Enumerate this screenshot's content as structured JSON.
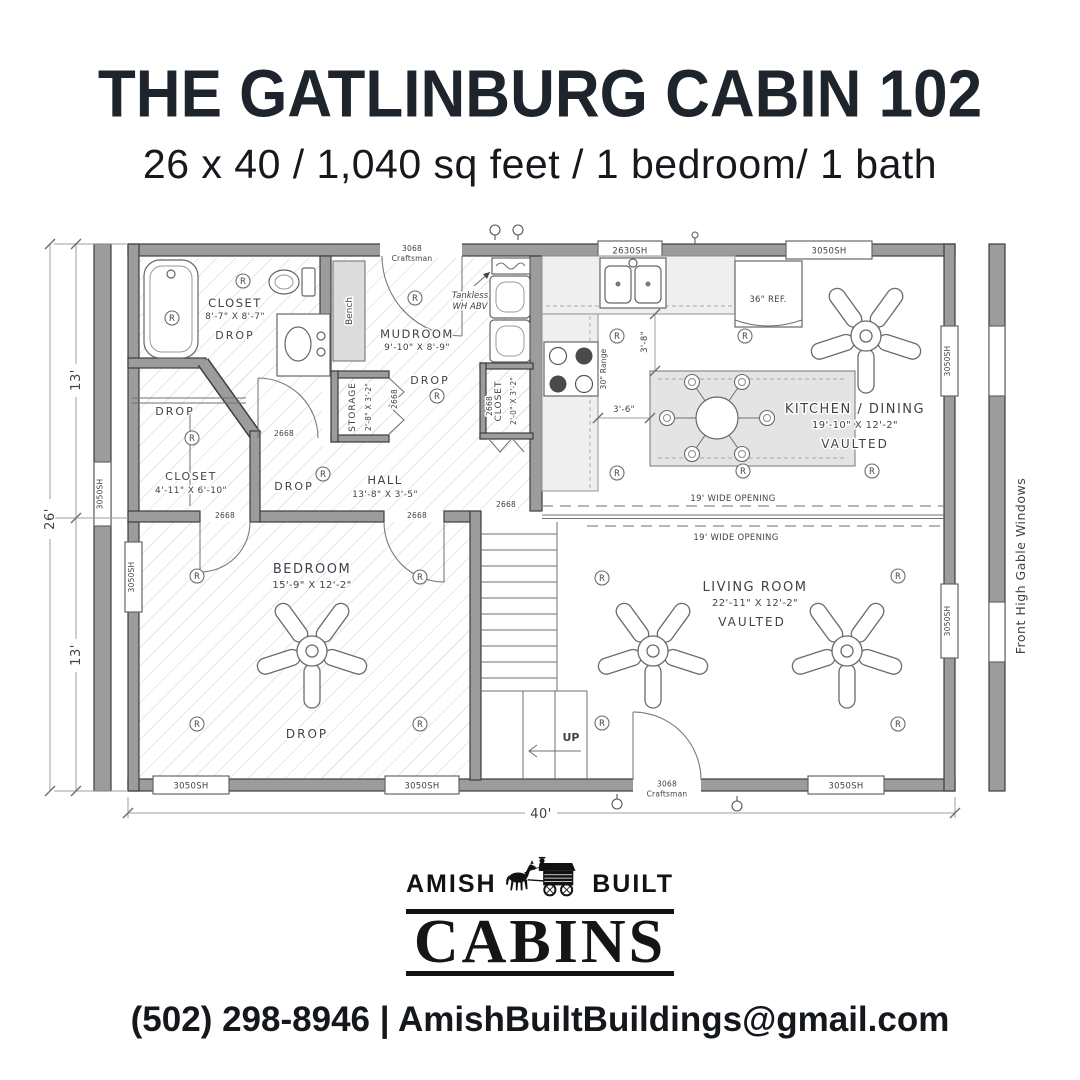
{
  "header": {
    "title": "THE GATLINBURG CABIN 102",
    "subtitle": "26 x 40 / 1,040 sq feet / 1 bedroom/ 1 bath"
  },
  "plan": {
    "dims": {
      "total_width": "40'",
      "total_depth": "26'",
      "depth_top": "13'",
      "depth_bottom": "13'",
      "island_aisle": "3'-6\"",
      "counter_aisle": "3'-8\""
    },
    "rooms": {
      "bath_closet": {
        "name": "CLOSET",
        "size": "8'-7\" X 8'-7\"",
        "ceiling": "DROP"
      },
      "mudroom": {
        "name": "MUDROOM",
        "size": "9'-10\" X 8'-9\"",
        "ceiling": "DROP"
      },
      "storage": {
        "name": "STORAGE",
        "size": "2'-8\" X 3'-2\""
      },
      "closet_bedroom": {
        "name": "CLOSET",
        "size": "4'-11\" X 6'-10\"",
        "ceiling": "DROP"
      },
      "hall": {
        "name": "HALL",
        "size": "13'-8\" X 3'-5\"",
        "ceiling": "DROP"
      },
      "closet_laundry": {
        "name": "CLOSET",
        "size": "2'-0\" X 3'-2\""
      },
      "kitchen": {
        "name": "KITCHEN / DINING",
        "size": "19'-10\" X 12'-2\"",
        "ceiling": "VAULTED"
      },
      "living": {
        "name": "LIVING ROOM",
        "size": "22'-11\" X 12'-2\"",
        "ceiling": "VAULTED"
      },
      "bedroom": {
        "name": "BEDROOM",
        "size": "15'-9\" X 12'-2\"",
        "ceiling": "DROP"
      }
    },
    "fixtures": {
      "bench": "Bench",
      "fridge": "36\" REF.",
      "range": "30\" Range",
      "tankless_line1": "Tankless",
      "tankless_line2": "WH ABV",
      "stairs_up": "UP"
    },
    "openings": {
      "exterior_door": "3068",
      "exterior_door_style": "Craftsman",
      "interior_door": "2668",
      "window": "3050SH",
      "kitchen_window": "2630SH",
      "wide_opening": "19' WIDE OPENING"
    },
    "notes": {
      "gable": "Front High Gable Windows"
    },
    "symbols": {
      "recessed_light": "R"
    }
  },
  "logo": {
    "word_left": "AMISH",
    "word_right": "BUILT",
    "brand": "CABINS"
  },
  "footer": {
    "contact": "(502) 298-8946 | AmishBuiltBuildings@gmail.com"
  }
}
